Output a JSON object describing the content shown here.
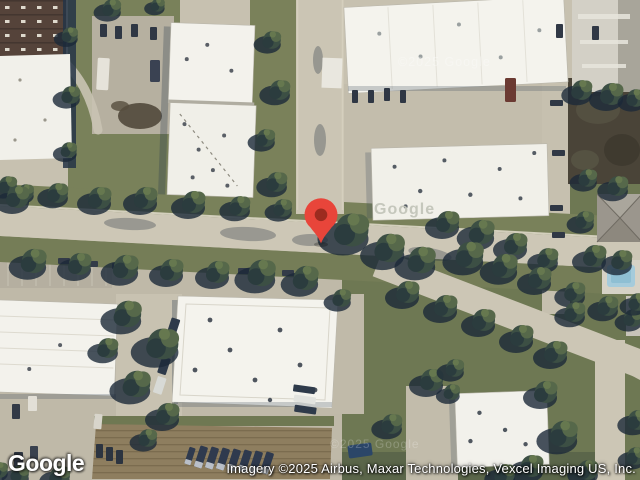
{
  "map": {
    "pin": {
      "icon": "red-map-pin",
      "fill": "#e8453a",
      "dot_fill": "#9c2b1f"
    },
    "watermarks": {
      "roof_copyright": "©2025 Google",
      "roof_logo": "Google",
      "road_copyright": "©2025 Google"
    }
  },
  "footer": {
    "logo_text": "Google",
    "attribution_text": "Imagery ©2025 Airbus, Maxar Technologies, Vexcel Imaging US, Inc."
  },
  "palette": {
    "pin_red": "#e8453a",
    "pin_dot": "#9c2b1f",
    "concrete": "#c7c1b0",
    "road": "#cdc7b6",
    "grass": "#79815a",
    "tree_canopy": "#3c4f44",
    "tree_shadow": "#1c2938",
    "roof_white": "#f3f2ec",
    "brick_roof": "#55433a",
    "dirt_field": "#8e7e5f"
  }
}
